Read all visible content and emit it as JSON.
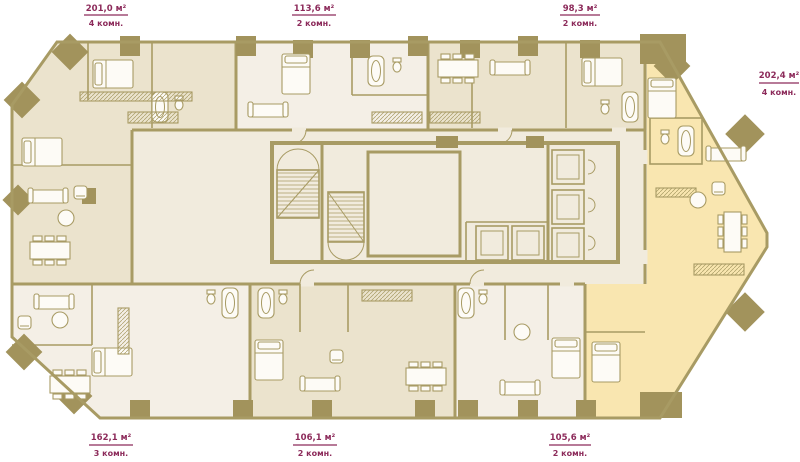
{
  "palette": {
    "wall": "#a89b64",
    "column": "#a2935c",
    "floor_beige": "#ebe3cd",
    "floor_light": "#f4efe6",
    "floor_highlight": "#f9e6b0",
    "common": "#f1ebdd",
    "label": "#8c2a5a",
    "paper": "#ffffff"
  },
  "apartments": [
    {
      "id": "top-left",
      "area": "201,0 м²",
      "rooms": "4 комн."
    },
    {
      "id": "top-middle",
      "area": "113,6 м²",
      "rooms": "2 комн."
    },
    {
      "id": "top-right",
      "area": "98,3 м²",
      "rooms": "2 комн."
    },
    {
      "id": "right",
      "area": "202,4 м²",
      "rooms": "4 комн."
    },
    {
      "id": "bottom-left",
      "area": "162,1 м²",
      "rooms": "3 комн."
    },
    {
      "id": "bottom-middle",
      "area": "106,1 м²",
      "rooms": "2 комн."
    },
    {
      "id": "bottom-right",
      "area": "105,6 м²",
      "rooms": "2 комн."
    }
  ]
}
